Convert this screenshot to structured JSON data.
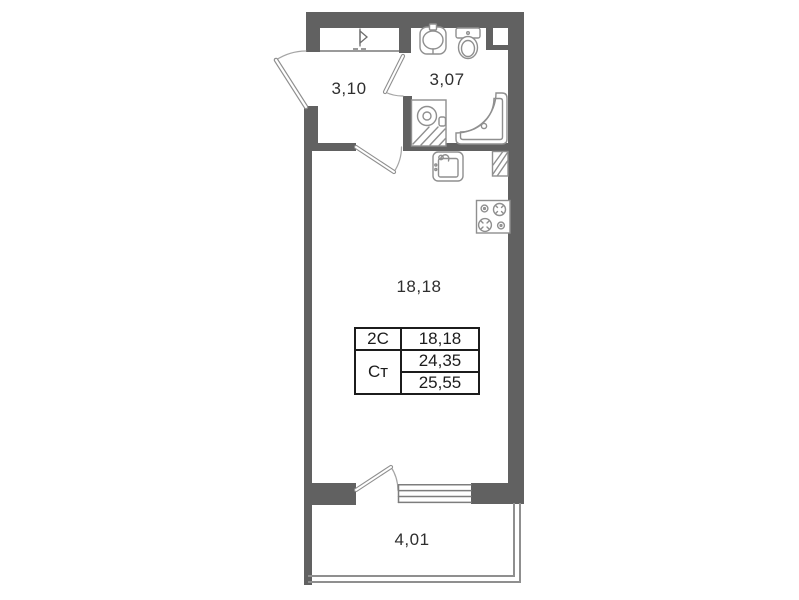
{
  "title": "Studio apartment floor plan",
  "rooms": {
    "hallway": {
      "area": "3,10"
    },
    "bathroom": {
      "area": "3,07"
    },
    "living_room": {
      "area": "18,18"
    },
    "balcony": {
      "area": "4,01"
    }
  },
  "info_table": {
    "row1": {
      "type": "2С",
      "value": "18,18"
    },
    "row2": {
      "type": "Ст",
      "value": "24,35"
    },
    "row3": {
      "value": "25,55"
    }
  },
  "colors": {
    "wall": "#616161",
    "fixture_line": "#8f8f8f",
    "swing_arc": "#a5a5a5",
    "text": "#2e2e2e",
    "table_border": "#1c1c1c",
    "background": "#ffffff"
  },
  "fixtures": {
    "wardrobe": "triangle-marker",
    "entrance_door": "door-swing-arc",
    "bathroom_door": "door-swing-arc",
    "room_door": "door-swing-arc",
    "balcony_door": "door-swing-arc",
    "washbasin": "oval-basin-pedestal",
    "toilet": "tank-and-bowl",
    "shower": "quarter-round-tray",
    "washing_machine": "square-drum-hatched",
    "kitchen_sink": "square-basin-faucet",
    "vent_shaft": "hatched-rect",
    "stove": "four-burner-cooktop",
    "window": "multi-line-glazing"
  }
}
